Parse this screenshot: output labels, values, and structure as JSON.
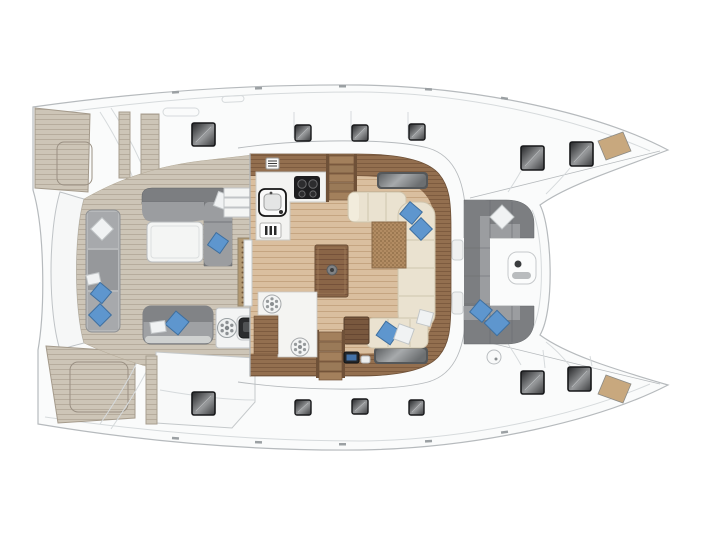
{
  "palette": {
    "bg": "#ffffff",
    "hull_fill": "#fafbfb",
    "hull_line": "#b6babd",
    "hull_line_soft": "#d6dadc",
    "teak_base": "#cdc5b7",
    "teak_stripe": "#b6ac9d",
    "floor_base": "#dabf9f",
    "floor_stripe": "#c5a581",
    "cabinet_base": "#936f4f",
    "cabinet_stripe": "#7d5b3f",
    "counter": "#f3f3f1",
    "counter_line": "#c8c8c5",
    "settee": "#eae2d0",
    "settee_line": "#cfc5ae",
    "table_base": "#8a6547",
    "table_stripe": "#75513a",
    "weave_base": "#b28c63",
    "weave_dot": "#9b7851",
    "grate_base": "#b29871",
    "grate_dot": "#715639",
    "sofa_back": "#7c7e81",
    "sofa_seat": "#9b9da0",
    "bench_light": "#a7a9ac",
    "bench_mid": "#96989b",
    "pillow_blue": "#5e96ce",
    "pillow_blue_dark": "#3e6f9f",
    "pillow_white": "#f0f2f3",
    "hatch_frame": "#17181a",
    "hatch_glass_dark": "#232426",
    "hatch_glass_light": "#97999b",
    "glass_frame": "#55585a",
    "stove_black": "#1d1d1f",
    "screen_blue": "#4472a8",
    "bow_pad_tan": "#c8a87e"
  },
  "icons": {
    "winch": "spoked-circle",
    "stool": "spoked-circle",
    "stove": "four-burner-cooktop",
    "sink": "rounded-square-basin",
    "cutlery": "fork-knife-panel",
    "vent": "louvre-grid",
    "nav_display": "blue-screen-panel",
    "table_pedestal": "round-base"
  },
  "inventory": {
    "deck_hatches": 12,
    "roof_skylights": 2,
    "blue_pillows": 9,
    "white_pillows": 7,
    "winches": 1,
    "stools": 2,
    "stove_burners": 4,
    "bow_seat_pads": 2
  }
}
